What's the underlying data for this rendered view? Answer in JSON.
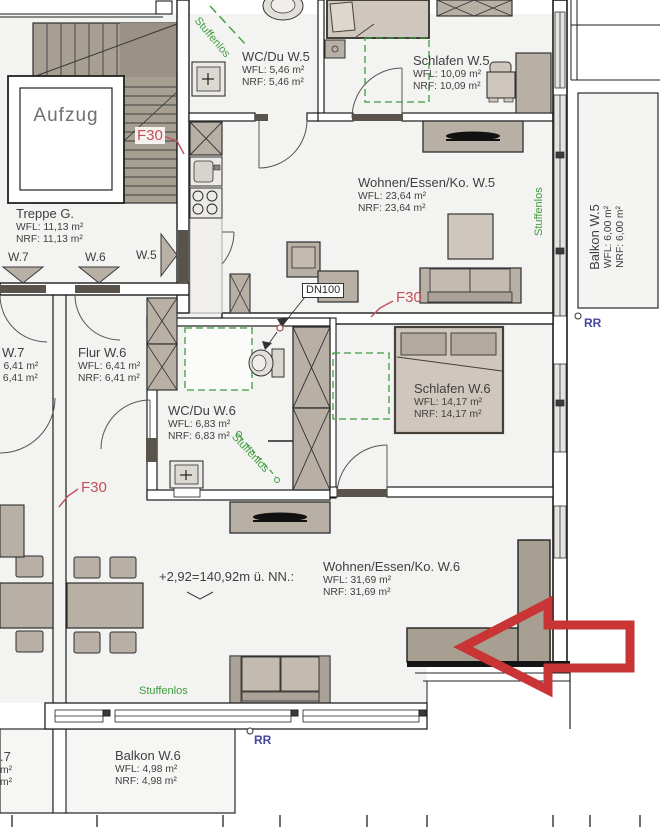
{
  "rooms": {
    "aufzug": {
      "name": "Aufzug"
    },
    "treppe": {
      "name": "Treppe G.",
      "wfl": "WFL: 11,13 m²",
      "nrf": "NRF: 11,13 m²"
    },
    "wc_du_w5": {
      "name": "WC/Du W.5",
      "wfl": "WFL: 5,46 m²",
      "nrf": "NRF: 5,46 m²"
    },
    "schlafen_w5": {
      "name": "Schlafen W.5",
      "wfl": "WFL: 10,09 m²",
      "nrf": "NRF: 10,09 m²"
    },
    "wohnen_w5": {
      "name": "Wohnen/Essen/Ko. W.5",
      "wfl": "WFL: 23,64 m²",
      "nrf": "NRF: 23,64 m²"
    },
    "balkon_w5": {
      "name": "Balkon W.5",
      "wfl": "WFL: 6,00 m²",
      "nrf": "NRF: 6,00 m²"
    },
    "flur_w7": {
      "name": "Flur W.7",
      "wfl": "WFL: 6,41 m²",
      "nrf": "NRF: 6,41 m²"
    },
    "flur_w6": {
      "name": "Flur W.6",
      "wfl": "WFL: 6,41 m²",
      "nrf": "NRF: 6,41 m²"
    },
    "wc_du_w6": {
      "name": "WC/Du W.6",
      "wfl": "WFL: 6,83 m²",
      "nrf": "NRF: 6,83 m²"
    },
    "schlafen_w6": {
      "name": "Schlafen W.6",
      "wfl": "WFL: 14,17 m²",
      "nrf": "NRF: 14,17 m²"
    },
    "wohnen_w6": {
      "name": "Wohnen/Essen/Ko. W.6",
      "wfl": "WFL: 31,69 m²",
      "nrf": "NRF: 31,69 m²"
    },
    "balkon_w6": {
      "name": "Balkon W.6",
      "wfl": "WFL: 4,98 m²",
      "nrf": "NRF: 4,98 m²"
    },
    "balkon_w7_partial": {
      "name": ".7",
      "wfl": "m²",
      "nrf": "m²"
    }
  },
  "annotations": {
    "fire_rating": "F30",
    "drain": "DN100",
    "stepless": "Stuffenlos",
    "rr": "RR",
    "level": "+2,92=140,92m ü. NN.:",
    "apt_w7": "W.7",
    "apt_w6": "W.6",
    "apt_w5": "W.5"
  },
  "colors": {
    "fire_red": "#c4505a",
    "arrow_red": "#c93434",
    "stepless_green": "#3f9b3f",
    "rr_blue": "#4646a0",
    "wall_brown": "#a89f93",
    "furniture": "#b8afa5"
  }
}
